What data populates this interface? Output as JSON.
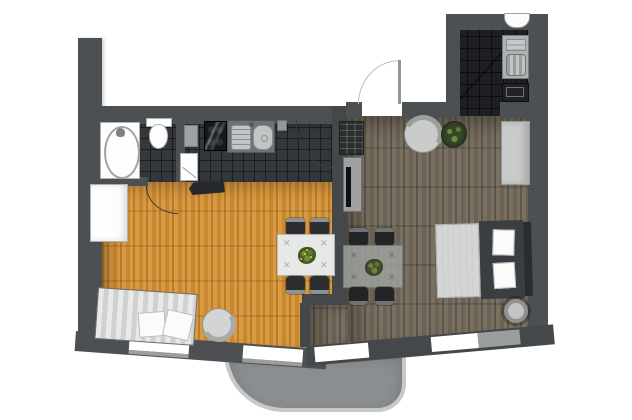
{
  "meta": {
    "type": "apartment-floor-plan",
    "view": "top-down",
    "text_labels": "none"
  },
  "palette": {
    "wall": "#4d5053",
    "wallDark": "#45484b",
    "tileFloor": "#34373b",
    "tileLine": "#1b1d20",
    "utilityFloor": "#1d1f22",
    "utilityLine": "#0c0d0f",
    "woodL1": "#c9882e",
    "woodL2": "#d79b45",
    "woodL3": "#bd7d27",
    "woodD1": "#6c6257",
    "woodD2": "#79705f",
    "woodD3": "#5e564c",
    "balcony": "#8b8e90",
    "balconyBorder": "#c6c8c9",
    "windowWhite": "#ffffff",
    "sill": "#9b9e9f",
    "chairDark": "#2c2e31",
    "chairBar": "#8f9294",
    "tableLight": "#e9eef0",
    "tableDark": "#9ea3a0",
    "plantGreen": "#47622c",
    "plantDark": "#37452a",
    "arcDark": "#3a3c3e",
    "arcLight": "#b9bec0"
  },
  "glyphs": {
    "cutlery": "✕"
  },
  "rooms": [
    {
      "id": "bathroom",
      "floor": "dark-tile",
      "fixtures": [
        "bathtub",
        "toilet",
        "door-swing"
      ]
    },
    {
      "id": "kitchen",
      "floor": "dark-tile",
      "fixtures": [
        "stove",
        "double-sink",
        "gray-panel",
        "white-cabinet",
        "wall-switch",
        "door-swing"
      ]
    },
    {
      "id": "living-room",
      "floor": "orange-wood",
      "furniture": [
        "striped-sofa",
        "tub-chair",
        "dining-table-with-plant",
        "4-chairs",
        "white-wardrobe",
        "tv-console"
      ]
    },
    {
      "id": "bedroom-hall",
      "floor": "dark-wood",
      "furniture": [
        "double-bed-two-pillows",
        "dining-table-with-plant",
        "4-chairs",
        "armchair",
        "plant",
        "wardrobe",
        "shelf-unit",
        "tv-sideboard",
        "round-stool"
      ]
    },
    {
      "id": "utility-room",
      "floor": "black-tile",
      "fixtures": [
        "basin",
        "washing-machine",
        "dark-appliance",
        "diagonal-mark"
      ]
    },
    {
      "id": "balcony",
      "floor": "concrete",
      "furniture": []
    }
  ],
  "doors": [
    {
      "id": "entry-door",
      "swing": "outward-top"
    },
    {
      "id": "bathroom-door",
      "swing": "into-living-room"
    },
    {
      "id": "kitchen-door",
      "swing": "into-kitchen"
    }
  ],
  "windows": {
    "count": 4,
    "location": "bottom-walls"
  }
}
